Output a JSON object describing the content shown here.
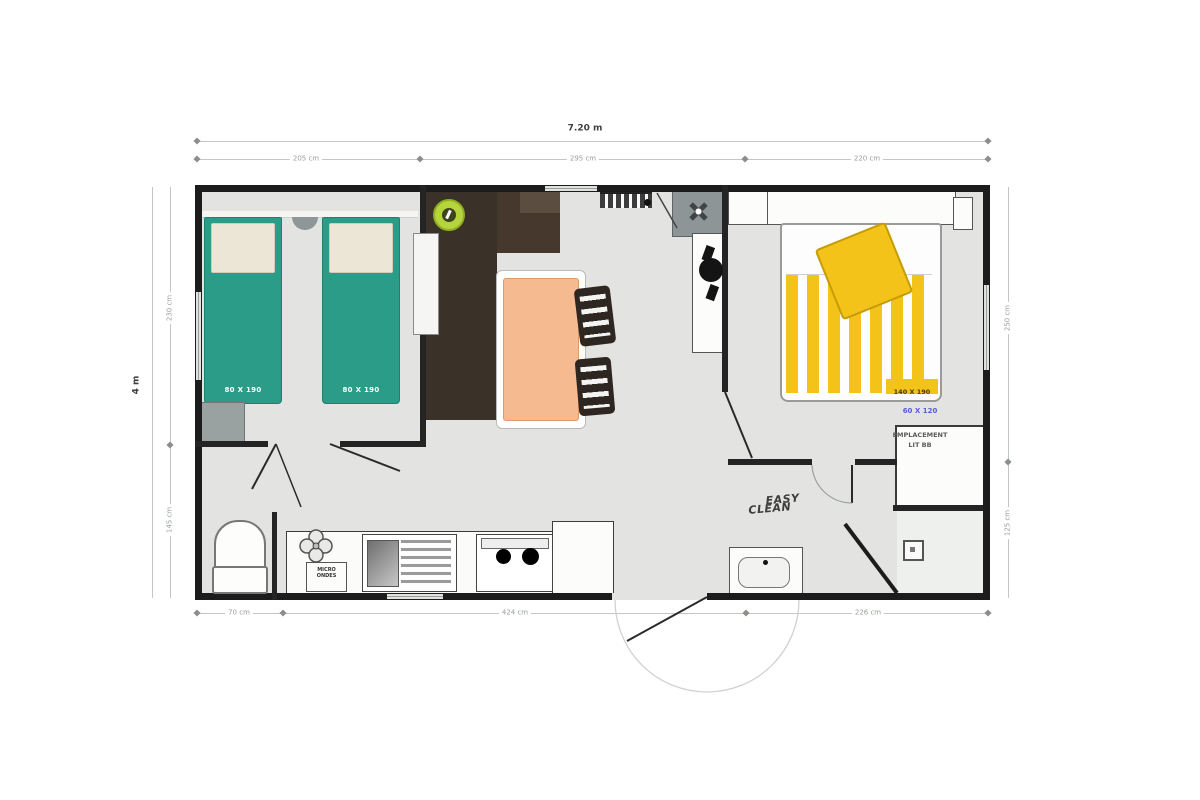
{
  "plan": {
    "type": "mobile-home floor plan, top view",
    "colors": {
      "wall": "#1c1c1c",
      "floor": "#e3e4e2",
      "twin_bed_teal": "#2b9c87",
      "double_bed_yellow": "#f3c319",
      "table_peach": "#f5ba90",
      "kitchen_brown": "#3a3129",
      "dim_text": "#98a098",
      "baby_note_blue": "#5a5ae0"
    },
    "icons": {
      "sink_circle": "round kitchen sink on dark worktop (lime ring)",
      "hob_burners": "two black burner circles",
      "gas_flower": "4-circle gas ring symbol",
      "fan": "boiler/vent fan cross in grey square",
      "heater": "black wall heater blob",
      "toilet": "WC bowl with cistern",
      "shower_drain": "square drain in shower corner",
      "door_swing": "thin diagonal door-leaf lines with faint arcs"
    }
  },
  "dimensions": {
    "overall_width": "7.20 m",
    "overall_height": "4 m",
    "top_segments": [
      "205 cm",
      "295 cm",
      "220 cm"
    ],
    "bottom_segments": [
      "70 cm",
      "424 cm",
      "226 cm"
    ],
    "left_segments": [
      "230 cm",
      "145 cm"
    ],
    "right_segments": [
      "250 cm",
      "125 cm"
    ]
  },
  "rooms": {
    "bedroom_twin": {
      "bed1_label": "80 X 190",
      "bed2_label": "80 X 190"
    },
    "bedroom_double": {
      "bed_label": "140 X 190",
      "baby_size": "60 X 120",
      "baby_line1": "EMPLACEMENT",
      "baby_line2": "LIT BB"
    },
    "bathroom": {
      "logo_line1": "EASY",
      "logo_line2": "CLEAN"
    },
    "kitchen": {
      "micro_line1": "MICRO",
      "micro_line2": "ONDES"
    }
  }
}
